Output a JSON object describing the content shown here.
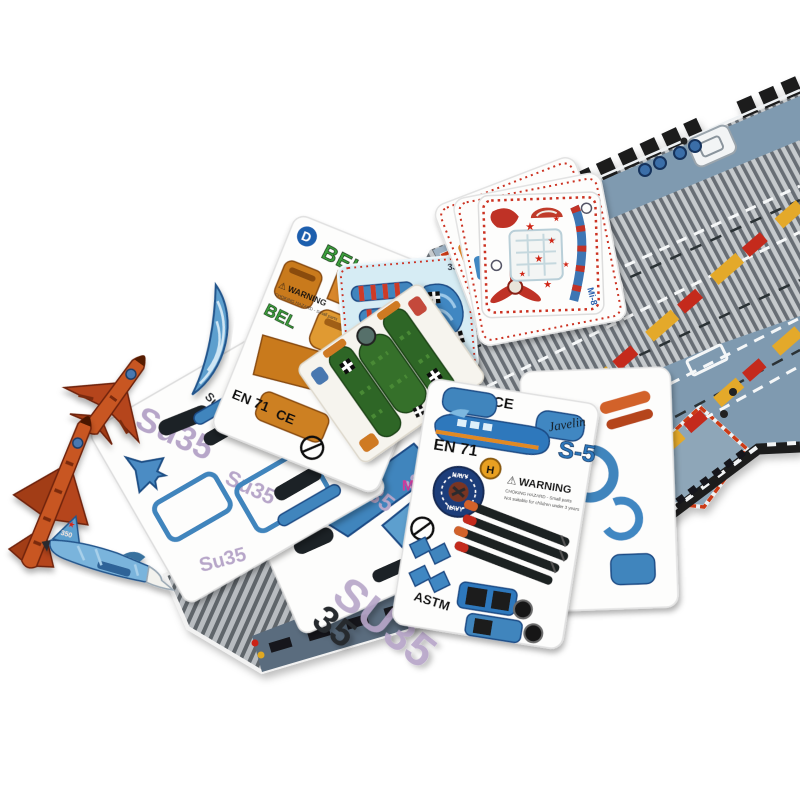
{
  "scene": {
    "description": "Product photo of a 3D cardboard puzzle aircraft carrier playset with punch-out plane part cards and assembled toy jets",
    "background": "#ffffff"
  },
  "icons": {
    "star": "★",
    "warning_triangle": "⚠"
  },
  "colors": {
    "stripe_light": "#c6cacd",
    "stripe_dark": "#686e74",
    "deck_blue": "#7f9ab0",
    "deck_blue_light": "#9db2c4",
    "rim_black": "#1b1c1e",
    "runway_yellow": "#e4a92a",
    "runway_red": "#c4291d",
    "runway_white": "#f5f7f8",
    "pad_red": "#cc3a16",
    "card_white": "#fdfdfc",
    "card_blue_bg": "#d6ecf4",
    "part_blue": "#3f85bd",
    "part_blue_dark": "#1a4c86",
    "part_blue_light": "#7db8e0",
    "part_orange": "#d8862a",
    "part_orange_dark": "#9c5a10",
    "su35_lavender": "#b7a6c9",
    "green_plane": "#2e6627",
    "heli_red": "#bf3326",
    "star_red": "#d02818",
    "navy_badge": "#1c3e7a",
    "missile_black": "#1f2022",
    "jet_orange": "#b5451f",
    "jet_blue": "#5d9fce",
    "bel_green": "#3da03c"
  },
  "texts": {
    "bel": {
      "badge": "D",
      "title": "BEL 209",
      "title2": "BEL",
      "warning": "WARNING",
      "warning_small": "CHOKING HAZARD - Small parts",
      "en71": "EN 71",
      "ce": "CE"
    },
    "heli": {
      "model": "Mi-8"
    },
    "biplane": {
      "num": "33"
    },
    "su35": {
      "model": "Su35",
      "model2": "SU35",
      "partnum": "35",
      "m": "M"
    },
    "javelin": {
      "ce": "CE",
      "brand": "Javelin",
      "model": "S-5",
      "en71": "EN 71",
      "h": "H",
      "warning": "WARNING",
      "warning_small": "CHOKING HAZARD - Small parts",
      "warning_small2": "Not suitable for children under 3 years",
      "navy": "NAVY",
      "astm": "ASTM"
    },
    "jet": {
      "tail": "350"
    }
  }
}
